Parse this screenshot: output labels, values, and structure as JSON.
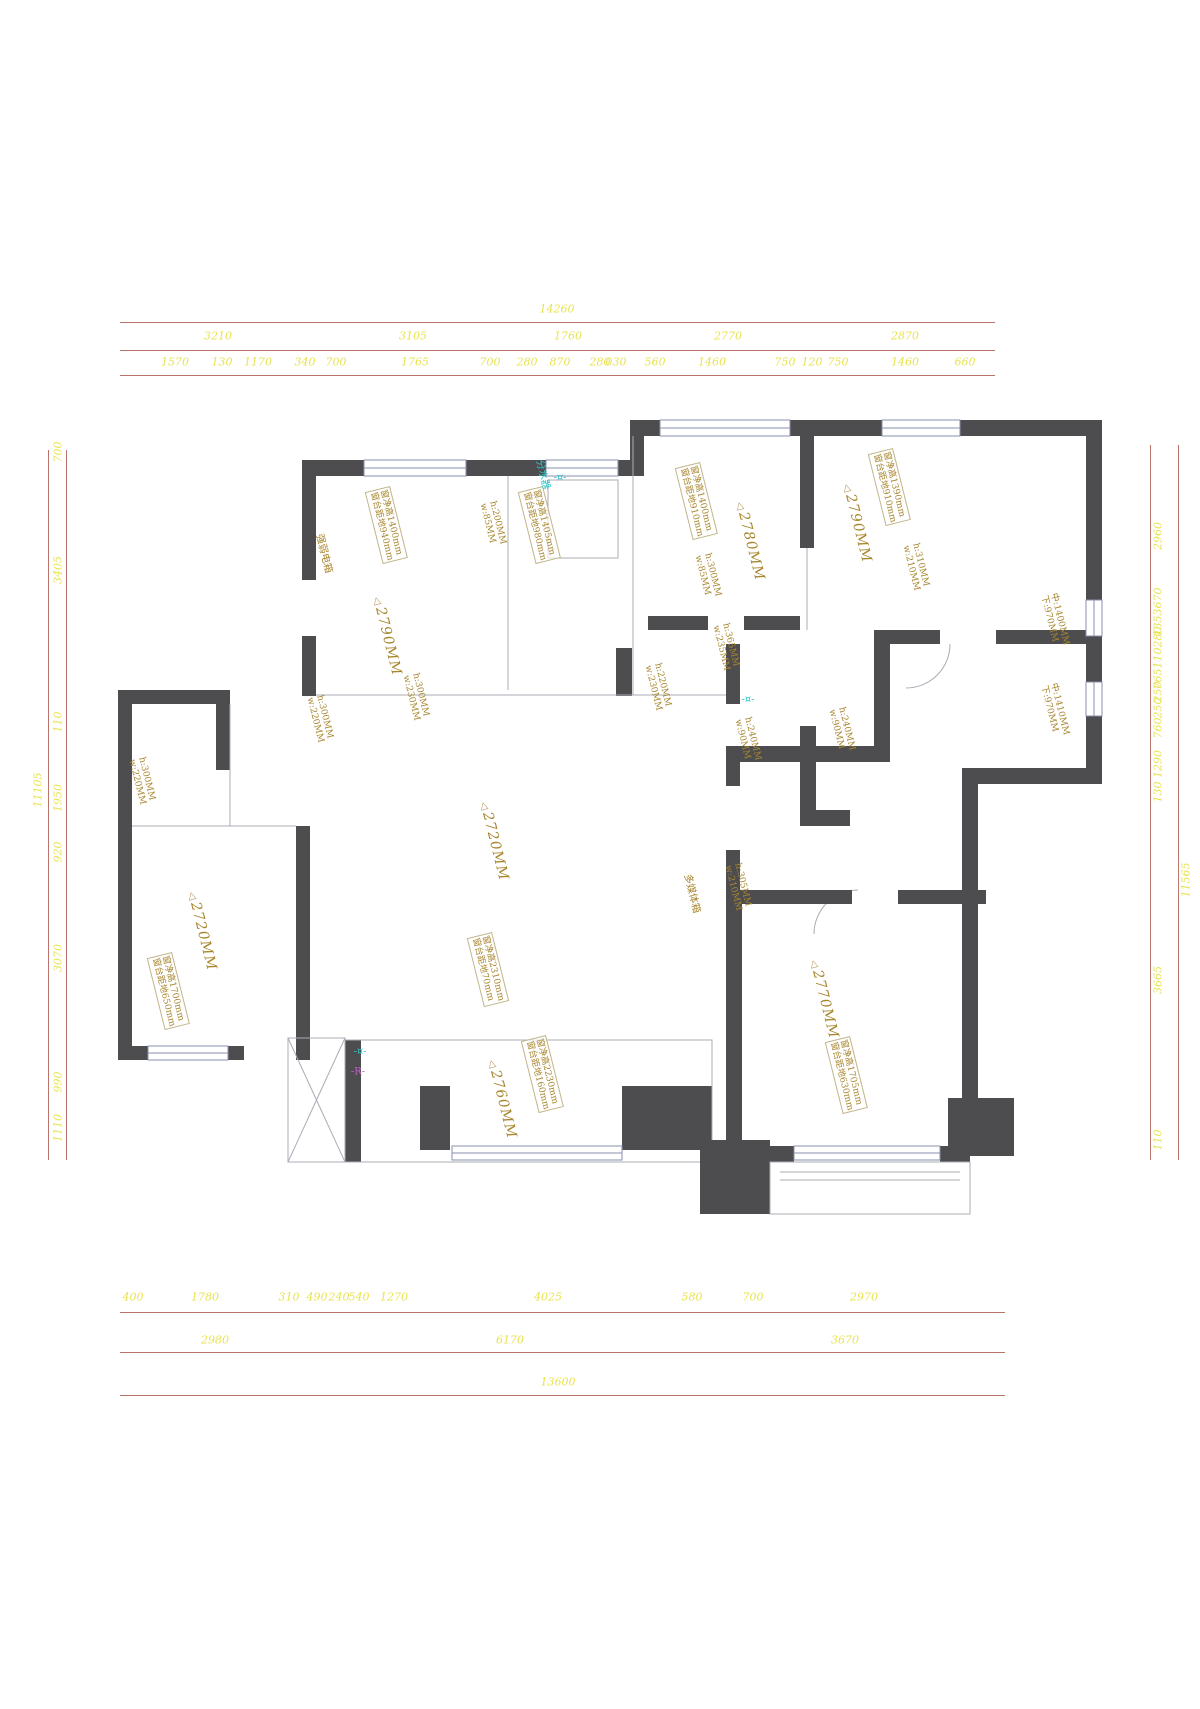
{
  "colors": {
    "dim_text": "#e8e34f",
    "dim_line": "#b9756b",
    "wall": "#4d4d4f",
    "annotation": "#a8862e",
    "cyan": "#2cc6c9",
    "magenta": "#c45ec9"
  },
  "dims": {
    "top": {
      "total": {
        "t": "14260",
        "x": 557,
        "y": 309
      },
      "row2": [
        {
          "t": "3210",
          "x": 218,
          "y": 336
        },
        {
          "t": "3105",
          "x": 413,
          "y": 336
        },
        {
          "t": "1760",
          "x": 568,
          "y": 336
        },
        {
          "t": "2770",
          "x": 728,
          "y": 336
        },
        {
          "t": "2870",
          "x": 905,
          "y": 336
        }
      ],
      "row3": [
        {
          "t": "1570",
          "x": 175,
          "y": 362
        },
        {
          "t": "130",
          "x": 222,
          "y": 362
        },
        {
          "t": "1170",
          "x": 258,
          "y": 362
        },
        {
          "t": "340",
          "x": 305,
          "y": 362
        },
        {
          "t": "700",
          "x": 336,
          "y": 362
        },
        {
          "t": "1765",
          "x": 415,
          "y": 362
        },
        {
          "t": "700",
          "x": 490,
          "y": 362
        },
        {
          "t": "280",
          "x": 527,
          "y": 362
        },
        {
          "t": "870",
          "x": 560,
          "y": 362
        },
        {
          "t": "280",
          "x": 600,
          "y": 362
        },
        {
          "t": "030",
          "x": 616,
          "y": 362
        },
        {
          "t": "560",
          "x": 655,
          "y": 362
        },
        {
          "t": "1460",
          "x": 712,
          "y": 362
        },
        {
          "t": "750",
          "x": 785,
          "y": 362
        },
        {
          "t": "120",
          "x": 812,
          "y": 362
        },
        {
          "t": "750",
          "x": 838,
          "y": 362
        },
        {
          "t": "1460",
          "x": 905,
          "y": 362
        },
        {
          "t": "660",
          "x": 965,
          "y": 362
        }
      ]
    },
    "bottom": {
      "row1": [
        {
          "t": "400",
          "x": 133,
          "y": 1297
        },
        {
          "t": "1780",
          "x": 205,
          "y": 1297
        },
        {
          "t": "310",
          "x": 289,
          "y": 1297
        },
        {
          "t": "490",
          "x": 317,
          "y": 1297
        },
        {
          "t": "240",
          "x": 339,
          "y": 1297
        },
        {
          "t": "540",
          "x": 359,
          "y": 1297
        },
        {
          "t": "1270",
          "x": 394,
          "y": 1297
        },
        {
          "t": "4025",
          "x": 548,
          "y": 1297
        },
        {
          "t": "580",
          "x": 692,
          "y": 1297
        },
        {
          "t": "700",
          "x": 753,
          "y": 1297
        },
        {
          "t": "2970",
          "x": 864,
          "y": 1297
        }
      ],
      "row2": [
        {
          "t": "2980",
          "x": 215,
          "y": 1340
        },
        {
          "t": "6170",
          "x": 510,
          "y": 1340
        },
        {
          "t": "3670",
          "x": 845,
          "y": 1340
        }
      ],
      "total": {
        "t": "13600",
        "x": 558,
        "y": 1382
      }
    },
    "left": {
      "outer": {
        "t": "11105",
        "x": 38,
        "y": 790
      },
      "inner": [
        {
          "t": "700",
          "x": 58,
          "y": 452
        },
        {
          "t": "3405",
          "x": 58,
          "y": 570
        },
        {
          "t": "110",
          "x": 58,
          "y": 722
        },
        {
          "t": "1950",
          "x": 58,
          "y": 798
        },
        {
          "t": "920",
          "x": 58,
          "y": 852
        },
        {
          "t": "3070",
          "x": 58,
          "y": 958
        },
        {
          "t": "990",
          "x": 58,
          "y": 1082
        },
        {
          "t": "1110",
          "x": 58,
          "y": 1128
        }
      ]
    },
    "right": {
      "outer": {
        "t": "11565",
        "x": 1186,
        "y": 880
      },
      "inner": [
        {
          "t": "2960",
          "x": 1158,
          "y": 536
        },
        {
          "t": "1353670",
          "x": 1158,
          "y": 612
        },
        {
          "t": "765110280",
          "x": 1158,
          "y": 658
        },
        {
          "t": "250",
          "x": 1158,
          "y": 692
        },
        {
          "t": "250",
          "x": 1158,
          "y": 708
        },
        {
          "t": "760",
          "x": 1158,
          "y": 728
        },
        {
          "t": "1290",
          "x": 1158,
          "y": 764
        },
        {
          "t": "130",
          "x": 1158,
          "y": 792
        },
        {
          "t": "3665",
          "x": 1158,
          "y": 980
        },
        {
          "t": "110",
          "x": 1158,
          "y": 1140
        }
      ]
    }
  },
  "rooms": [
    {
      "t": "2790MM",
      "x": 385,
      "y": 595
    },
    {
      "t": "2780MM",
      "x": 748,
      "y": 500
    },
    {
      "t": "2790MM",
      "x": 855,
      "y": 482
    },
    {
      "t": "2720MM",
      "x": 492,
      "y": 800
    },
    {
      "t": "2720MM",
      "x": 200,
      "y": 890
    },
    {
      "t": "2760MM",
      "x": 500,
      "y": 1058
    },
    {
      "t": "2770MM",
      "x": 822,
      "y": 958
    }
  ],
  "windows": [
    {
      "l1": "窗净高1400mm",
      "l2": "窗台距地940mm",
      "x": 390,
      "y": 486
    },
    {
      "l1": "窗净高1405mm",
      "l2": "窗台距地980mm",
      "x": 543,
      "y": 486
    },
    {
      "l1": "窗净高1400mm",
      "l2": "窗台距地910mm",
      "x": 700,
      "y": 462
    },
    {
      "l1": "窗净高1390mm",
      "l2": "窗台距地910mm",
      "x": 893,
      "y": 448
    },
    {
      "l1": "窗净高1700mm",
      "l2": "窗台距地650mm",
      "x": 172,
      "y": 952
    },
    {
      "l1": "窗净高2310mm",
      "l2": "窗台距地70mm",
      "x": 492,
      "y": 932
    },
    {
      "l1": "窗净高2230mm",
      "l2": "窗台距地160mm",
      "x": 546,
      "y": 1035
    },
    {
      "l1": "窗净高1705mm",
      "l2": "窗台距地630mm",
      "x": 850,
      "y": 1036
    }
  ],
  "beams": [
    {
      "l1": "h:200MM",
      "l2": "w:85MM",
      "x": 497,
      "y": 500
    },
    {
      "l1": "h:300MM",
      "l2": "w:85MM",
      "x": 712,
      "y": 552
    },
    {
      "l1": "h:310MM",
      "l2": "w:210MM",
      "x": 920,
      "y": 542
    },
    {
      "l1": "h:365MM",
      "l2": "w:235MM",
      "x": 730,
      "y": 622
    },
    {
      "l1": "h:220MM",
      "l2": "w:230MM",
      "x": 662,
      "y": 662
    },
    {
      "l1": "h:300MM",
      "l2": "w:230MM",
      "x": 420,
      "y": 672
    },
    {
      "l1": "h:300MM",
      "l2": "w:220MM",
      "x": 324,
      "y": 694
    },
    {
      "l1": "h:300MM",
      "l2": "w:220MM",
      "x": 146,
      "y": 756
    },
    {
      "l1": "h:240MM",
      "l2": "w:90MM",
      "x": 752,
      "y": 716
    },
    {
      "l1": "h:240MM",
      "l2": "w:90MM",
      "x": 846,
      "y": 706
    },
    {
      "l1": "h:305MM",
      "l2": "w:210MM",
      "x": 742,
      "y": 862
    }
  ],
  "levels": [
    {
      "l1": "中:1400MM",
      "l2": "下:970MM",
      "x": 1058,
      "y": 592
    },
    {
      "l1": "中:1410MM",
      "l2": "下:970MM",
      "x": 1058,
      "y": 682
    }
  ],
  "equipment": [
    {
      "t": "强弱电箱",
      "x": 328,
      "y": 532,
      "c": "#a8862e"
    },
    {
      "t": "分水器",
      "x": 548,
      "y": 458,
      "c": "#2cc6c9"
    },
    {
      "t": "多媒体箱",
      "x": 696,
      "y": 872,
      "c": "#a8862e"
    }
  ],
  "symbols": [
    {
      "t": "-¤-",
      "x": 560,
      "y": 478,
      "c": "#2cc6c9"
    },
    {
      "t": "-R-",
      "x": 358,
      "y": 1072,
      "c": "#c45ec9"
    },
    {
      "t": "-¤-",
      "x": 748,
      "y": 700,
      "c": "#2cc6c9"
    },
    {
      "t": "-¤-",
      "x": 360,
      "y": 1052,
      "c": "#2cc6c9"
    }
  ]
}
